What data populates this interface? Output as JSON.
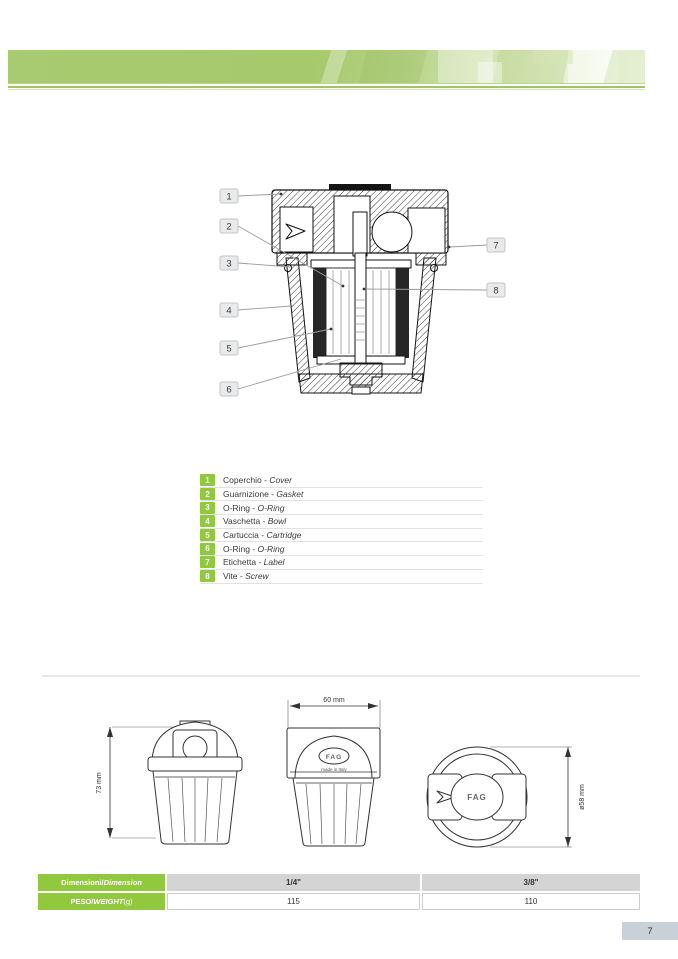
{
  "colors": {
    "brand_green": "#92c83e",
    "band_green": "#a6c96c",
    "rule_green": "#9fc463",
    "table_header_gray": "#d2d4d5",
    "page_box_gray": "#c8d1d7"
  },
  "figure": {
    "callouts": [
      "1",
      "2",
      "3",
      "4",
      "5",
      "6",
      "7",
      "8"
    ]
  },
  "parts_table": {
    "separator": " - ",
    "rows": [
      {
        "num": "1",
        "it": "Coperchio",
        "en": "Cover"
      },
      {
        "num": "2",
        "it": "Guarnizione",
        "en": "Gasket"
      },
      {
        "num": "3",
        "it": "O-Ring",
        "en": "O-Ring"
      },
      {
        "num": "4",
        "it": "Vaschetta",
        "en": "Bowl"
      },
      {
        "num": "5",
        "it": "Cartuccia",
        "en": "Cartridge"
      },
      {
        "num": "6",
        "it": "O-Ring",
        "en": "O-Ring"
      },
      {
        "num": "7",
        "it": "Etichetta",
        "en": "Label"
      },
      {
        "num": "8",
        "it": "Vite",
        "en": "Screw"
      }
    ]
  },
  "drawings": {
    "left": {
      "dimension": "73 mm"
    },
    "middle": {
      "dimension": "60 mm",
      "logo": "FAG",
      "made_in": "made in Italy"
    },
    "right": {
      "dimension": "ø58 mm",
      "logo": "FAG"
    }
  },
  "spec_table": {
    "header_label_it": "Dimensioni",
    "header_label_sep": " / ",
    "header_label_en": "Dimension",
    "size_1": "1/4\"",
    "size_2": "3/8\"",
    "weight_label_it": "PESO",
    "weight_label_sep": " / ",
    "weight_label_en": "WEIGHT",
    "weight_unit": " (g)",
    "weight_1": "115",
    "weight_2": "110"
  },
  "footer": {
    "page_number": "7"
  }
}
